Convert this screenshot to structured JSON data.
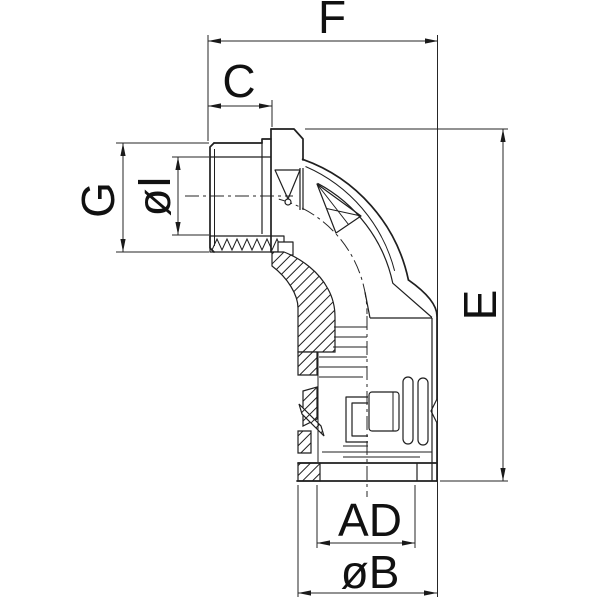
{
  "page": {
    "background": "#ffffff"
  },
  "drawing": {
    "kind": "technical line drawing — 90-degree elbow conduit fitting, half-section side view",
    "line_color": "#1f1f1f",
    "dimensions": {
      "overall_width": "F",
      "thread_length": "C",
      "thread_size": "G",
      "inner_diameter": "øI",
      "overall_height": "E",
      "outlet_inner_diameter": "AD",
      "outlet_outer_diameter": "øB"
    }
  }
}
